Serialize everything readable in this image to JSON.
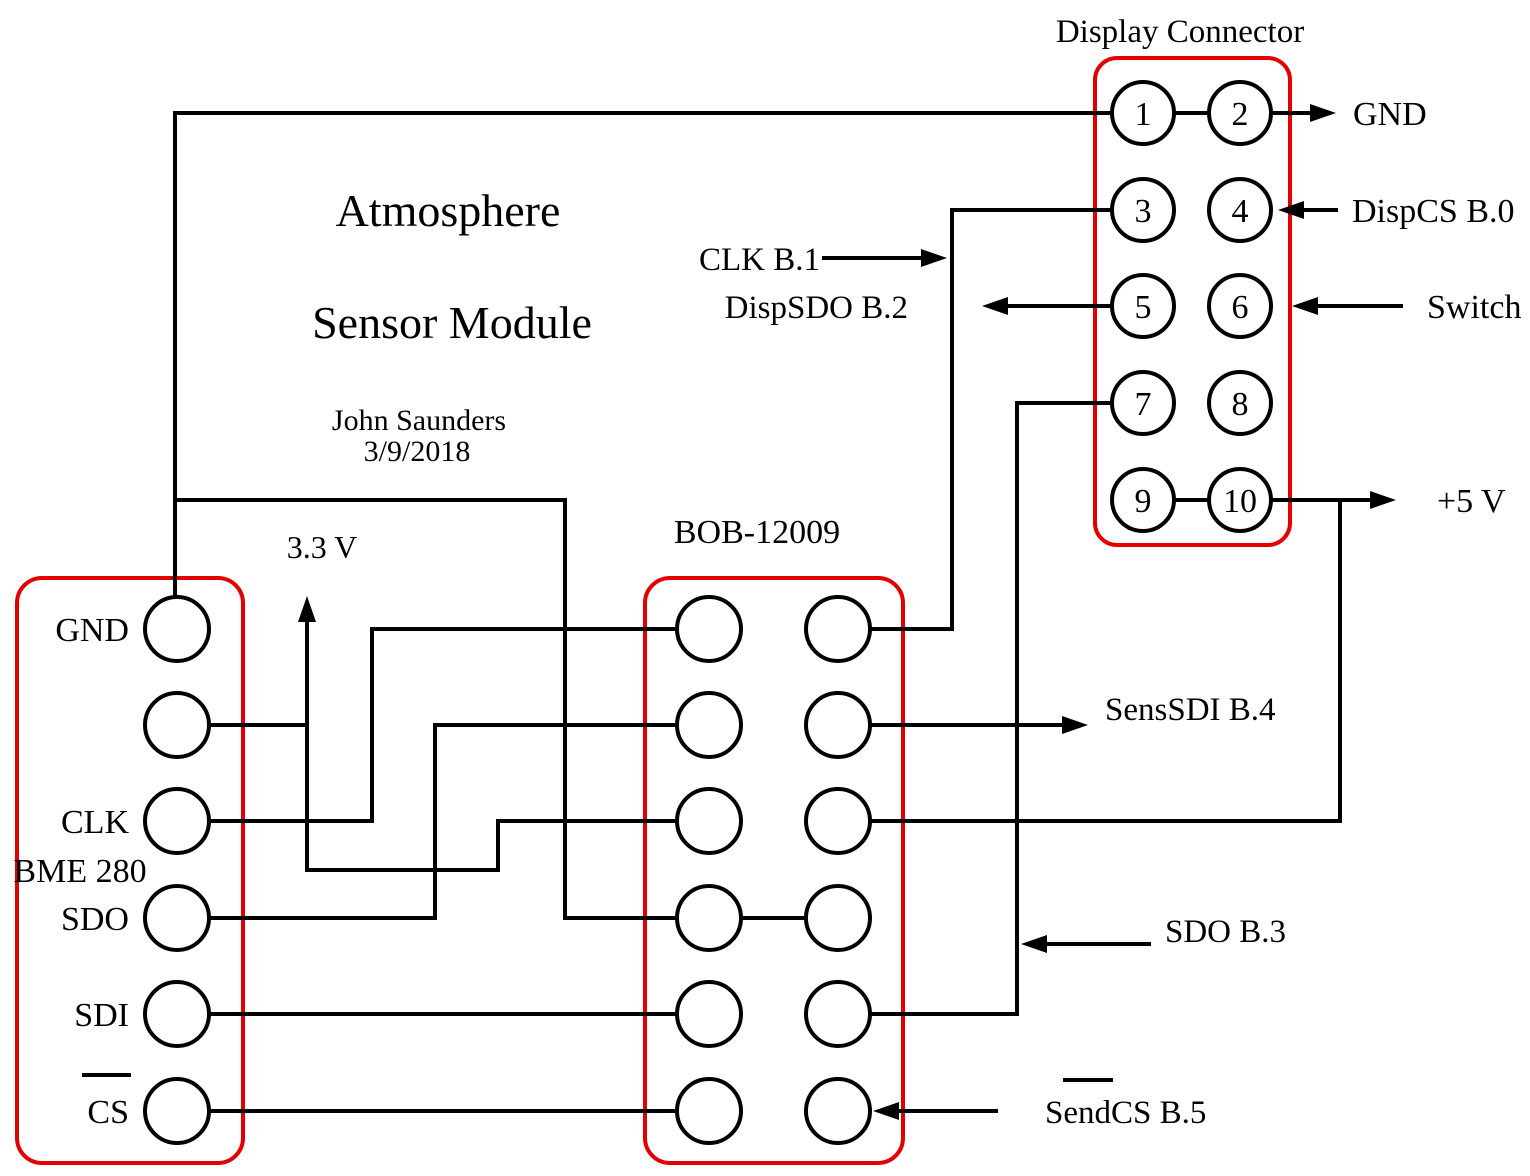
{
  "colors": {
    "wire": "#000000",
    "frame": "#e30000",
    "background": "#ffffff"
  },
  "title": {
    "line1": "Atmosphere",
    "line2": "Sensor Module",
    "author": "John Saunders",
    "date": "3/9/2018"
  },
  "bme": {
    "name": "BME 280",
    "supply_label": "3.3 V",
    "pin_labels": {
      "gnd": "GND",
      "clk": "CLK",
      "sdo": "SDO",
      "sdi": "SDI",
      "cs": "CS"
    }
  },
  "bob": {
    "name": "BOB-12009"
  },
  "display": {
    "name": "Display Connector",
    "pins": [
      "1",
      "2",
      "3",
      "4",
      "5",
      "6",
      "7",
      "8",
      "9",
      "10"
    ]
  },
  "signals": {
    "gnd": "GND",
    "dispcs": "DispCS B.0",
    "switch": "Switch",
    "plus5": "+5 V",
    "clk": "CLK B.1",
    "dispsdo": "DispSDO B.2",
    "senssdi": "SensSDI B.4",
    "sdo": "SDO B.3",
    "sendcs": "SendCS B.5"
  }
}
